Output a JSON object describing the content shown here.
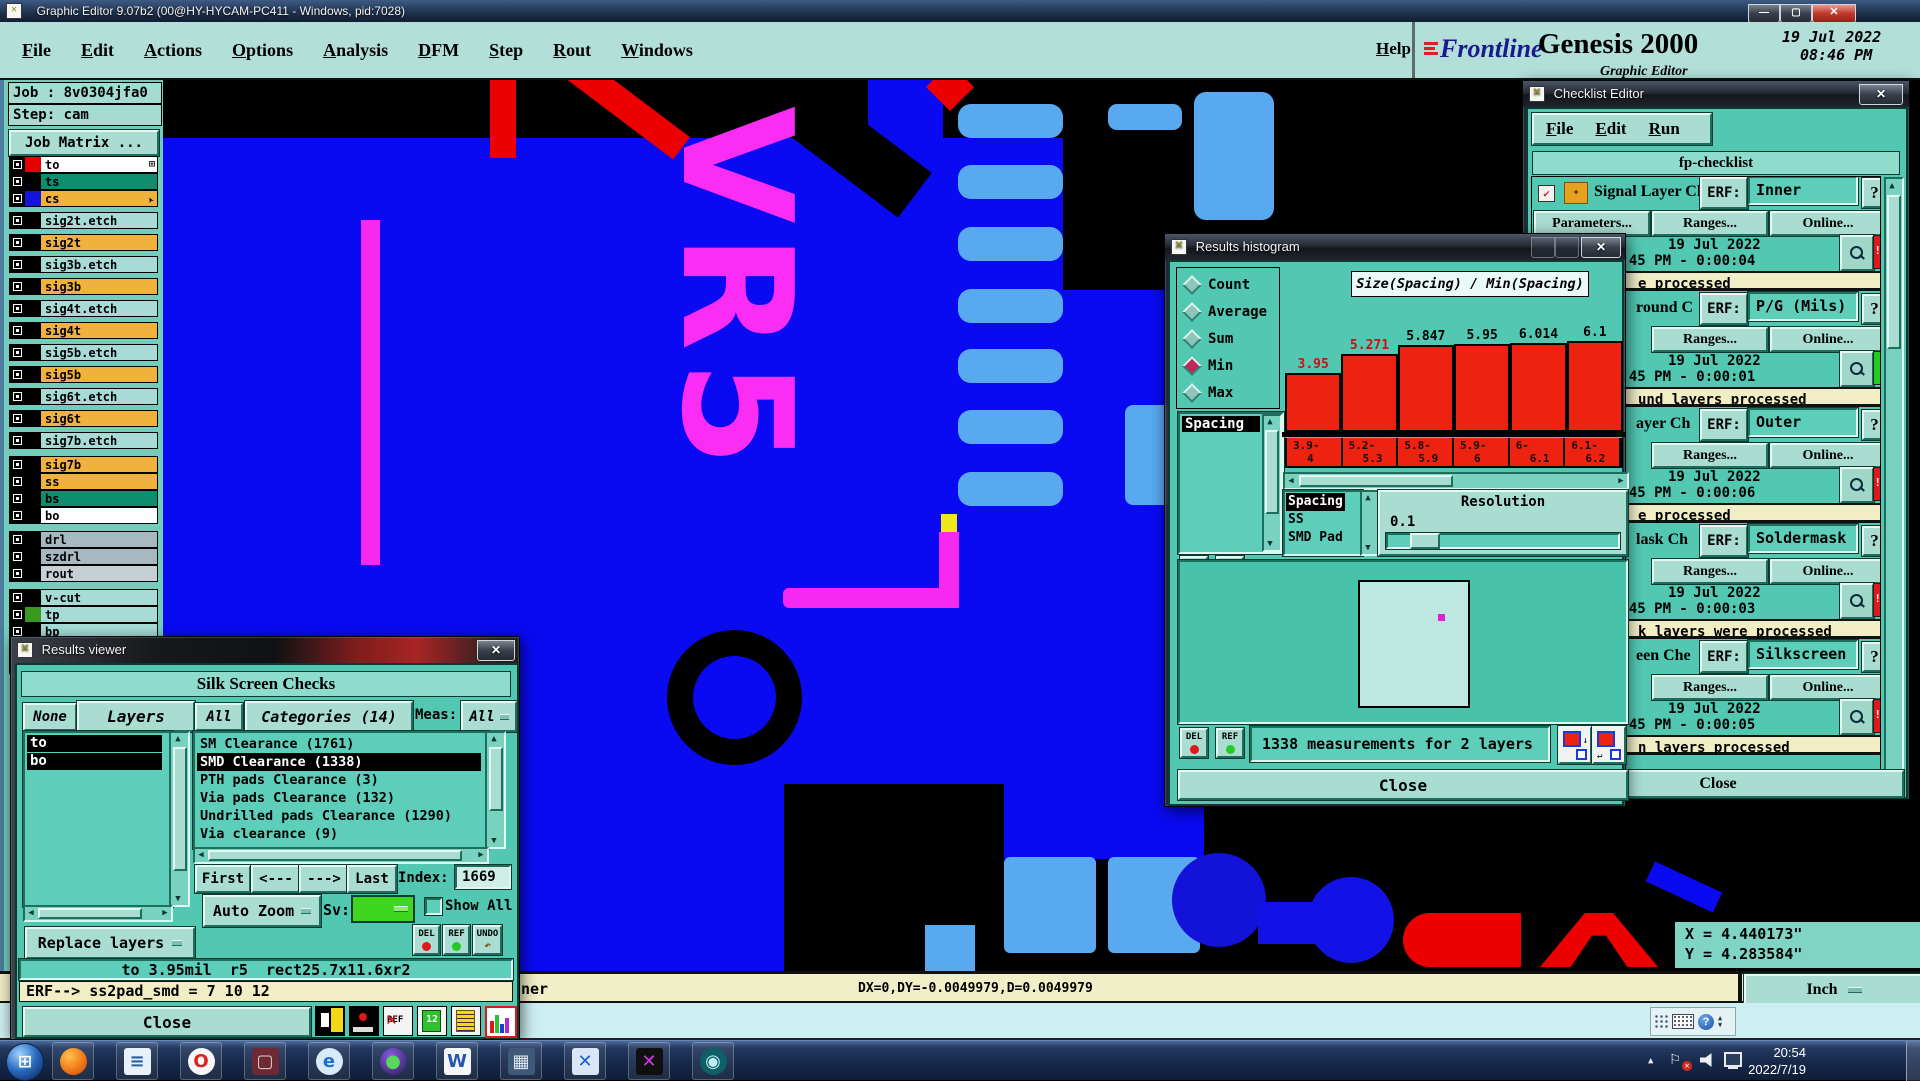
{
  "glyphs": {
    "min": "—",
    "max": "▢",
    "close": "✕",
    "up": "▲",
    "down": "▼",
    "left": "◀",
    "right": "▶",
    "q": "?",
    "bang": "!!",
    "check": "✔",
    "grid": "⊞",
    "start": "⊞",
    "tray_up": "▲",
    "flag": "⚐"
  },
  "window": {
    "title": "Graphic Editor 9.07b2 (00@HY-HYCAM-PC411 - Windows, pid:7028)"
  },
  "menubar": {
    "items": [
      "File",
      "Edit",
      "Actions",
      "Options",
      "Analysis",
      "DFM",
      "Step",
      "Rout",
      "Windows"
    ],
    "help": "Help",
    "brand": {
      "name": "Frontline",
      "product": "Genesis 2000",
      "subtitle": "Graphic Editor",
      "date": "19 Jul 2022",
      "time": "08:46 PM"
    }
  },
  "sidebar": {
    "job": "Job : 8v0304jfa0",
    "step": "Step: cam",
    "job_matrix": "Job Matrix ...",
    "layers": [
      {
        "name": "to",
        "bg": "#ffffff",
        "sw": "#e60000",
        "mt": "0px",
        "trail": "⊞",
        "rot": "none"
      },
      {
        "name": "ts",
        "bg": "#0e8e6e",
        "sw": "#000000",
        "mt": "0px",
        "trail": "",
        "rot": "none"
      },
      {
        "name": "cs",
        "bg": "#f0b23c",
        "sw": "#1414dd",
        "mt": "0px",
        "trail": "➤",
        "rot": "rotate(-120deg)"
      },
      {
        "name": "sig2t.etch",
        "bg": "#a6dbd6",
        "sw": "#000000",
        "mt": "5px",
        "trail": "",
        "rot": "none"
      },
      {
        "name": "sig2t",
        "bg": "#f0b23c",
        "sw": "#000000",
        "mt": "5px",
        "trail": "",
        "rot": "none"
      },
      {
        "name": "sig3b.etch",
        "bg": "#a6dbd6",
        "sw": "#000000",
        "mt": "5px",
        "trail": "",
        "rot": "none"
      },
      {
        "name": "sig3b",
        "bg": "#f0b23c",
        "sw": "#000000",
        "mt": "5px",
        "trail": "",
        "rot": "none"
      },
      {
        "name": "sig4t.etch",
        "bg": "#a6dbd6",
        "sw": "#000000",
        "mt": "5px",
        "trail": "",
        "rot": "none"
      },
      {
        "name": "sig4t",
        "bg": "#f0b23c",
        "sw": "#000000",
        "mt": "5px",
        "trail": "",
        "rot": "none"
      },
      {
        "name": "sig5b.etch",
        "bg": "#a6dbd6",
        "sw": "#000000",
        "mt": "5px",
        "trail": "",
        "rot": "none"
      },
      {
        "name": "sig5b",
        "bg": "#f0b23c",
        "sw": "#000000",
        "mt": "5px",
        "trail": "",
        "rot": "none"
      },
      {
        "name": "sig6t.etch",
        "bg": "#a6dbd6",
        "sw": "#000000",
        "mt": "5px",
        "trail": "",
        "rot": "none"
      },
      {
        "name": "sig6t",
        "bg": "#f0b23c",
        "sw": "#000000",
        "mt": "5px",
        "trail": "",
        "rot": "none"
      },
      {
        "name": "sig7b.etch",
        "bg": "#a6dbd6",
        "sw": "#000000",
        "mt": "5px",
        "trail": "",
        "rot": "none"
      },
      {
        "name": "sig7b",
        "bg": "#f0b23c",
        "sw": "#000000",
        "mt": "7px",
        "trail": "",
        "rot": "none"
      },
      {
        "name": "ss",
        "bg": "#f0b23c",
        "sw": "#000000",
        "mt": "0px",
        "trail": "",
        "rot": "none"
      },
      {
        "name": "bs",
        "bg": "#0e8e6e",
        "sw": "#000000",
        "mt": "0px",
        "trail": "",
        "rot": "none"
      },
      {
        "name": "bo",
        "bg": "#ffffff",
        "sw": "#000000",
        "mt": "0px",
        "trail": "",
        "rot": "none"
      },
      {
        "name": "drl",
        "bg": "#a8b8c0",
        "sw": "#000000",
        "mt": "7px",
        "trail": "",
        "rot": "none"
      },
      {
        "name": "szdrl",
        "bg": "#a8b8c0",
        "sw": "#000000",
        "mt": "0px",
        "trail": "",
        "rot": "none"
      },
      {
        "name": "rout",
        "bg": "#c6d0d4",
        "sw": "#000000",
        "mt": "0px",
        "trail": "",
        "rot": "none"
      },
      {
        "name": "v-cut",
        "bg": "#a6dbd6",
        "sw": "#000000",
        "mt": "7px",
        "trail": "",
        "rot": "none"
      },
      {
        "name": "tp",
        "bg": "#a6dbd6",
        "sw": "#3a9a20",
        "mt": "0px",
        "trail": "",
        "rot": "none"
      },
      {
        "name": "bp",
        "bg": "#a6dbd6",
        "sw": "#000000",
        "mt": "0px",
        "trail": "",
        "rot": "none"
      },
      {
        "name": "np",
        "bg": "#a6dbd6",
        "sw": "#000000",
        "mt": "0px",
        "trail": "",
        "rot": "none"
      },
      {
        "name": "mpth",
        "bg": "#a6dbd6",
        "sw": "#000000",
        "mt": "0px",
        "trail": "",
        "rot": "none"
      }
    ]
  },
  "canvas": {
    "vr5": "VR5",
    "coord_x": "X = 4.440173\"",
    "coord_y": "Y = 4.283584\""
  },
  "results_viewer": {
    "title": "Results viewer",
    "header": "Silk Screen Checks",
    "none": "None",
    "layers_btn": "Layers",
    "all": "All",
    "categories": "Categories (14)",
    "meas": "Meas:",
    "meas_value": "All",
    "layer_list": [
      {
        "label": "to"
      },
      {
        "label": "bo"
      }
    ],
    "cat_list": [
      {
        "label": "SM Clearance (1761)",
        "bg": "transparent",
        "fg": "#000000"
      },
      {
        "label": "SMD Clearance (1338)",
        "bg": "#000000",
        "fg": "#ffffff"
      },
      {
        "label": "PTH pads Clearance (3)",
        "bg": "transparent",
        "fg": "#000000"
      },
      {
        "label": "Via pads Clearance (132)",
        "bg": "transparent",
        "fg": "#000000"
      },
      {
        "label": "Undrilled pads Clearance (1290)",
        "bg": "transparent",
        "fg": "#000000"
      },
      {
        "label": "Via clearance (9)",
        "bg": "transparent",
        "fg": "#000000"
      }
    ],
    "nav": {
      "first": "First",
      "prev": "<---",
      "next": "--->",
      "last": "Last",
      "index_label": "Index:",
      "index_value": "1669"
    },
    "auto_zoom": "Auto Zoom",
    "sv": "Sv:",
    "show_all": "Show All",
    "replace": "Replace layers",
    "del": "DEL",
    "ref": "REF",
    "undo": "UNDO",
    "status1": "to 3.95mil  r5  rect25.7x11.6xr2",
    "status2": "ERF--> ss2pad_smd = 7 10 12",
    "close": "Close",
    "icon12": "12",
    "icon_ref": "REF"
  },
  "histogram": {
    "title": "Results histogram",
    "stats": [
      {
        "label": "Count",
        "dcol": "#8fc4ba"
      },
      {
        "label": "Average",
        "dcol": "#8fc4ba"
      },
      {
        "label": "Sum",
        "dcol": "#8fc4ba"
      },
      {
        "label": "Min",
        "dcol": "#c2245c"
      },
      {
        "label": "Max",
        "dcol": "#8fc4ba"
      }
    ],
    "series_list": [
      {
        "label": "Spacing",
        "bg": "#000000",
        "fg": "#ffffff"
      }
    ],
    "sub_list": [
      {
        "label": "Spacing",
        "bg": "#000000",
        "fg": "#ffffff"
      },
      {
        "label": "SS",
        "bg": "transparent",
        "fg": "#000000"
      },
      {
        "label": "SMD Pad",
        "bg": "transparent",
        "fg": "#000000"
      }
    ],
    "resolution_label": "Resolution",
    "resolution_value": "0.1",
    "del": "DEL",
    "ref": "REF",
    "measurements": "1338 measurements for 2 layers",
    "close": "Close",
    "chart_data": {
      "type": "bar",
      "title": "Size(Spacing) / Min(Spacing)",
      "categories": [
        "3.9-4",
        "5.2-5.3",
        "5.8-5.9",
        "5.9-6",
        "6-6.1",
        "6.1-6.2"
      ],
      "values": [
        3.95,
        5.271,
        5.847,
        5.95,
        6.014,
        6.1
      ],
      "value_label_colors": [
        "#cc1111",
        "#cc1111",
        "#000000",
        "#000000",
        "#000000",
        "#000000"
      ],
      "xlabel": "Size(Spacing) bins (mil)",
      "ylabel": "Min(Spacing)",
      "ylim": [
        0,
        6.2
      ],
      "bar_color": "#ee2211",
      "legend": "off",
      "grid": "off"
    }
  },
  "checklist": {
    "title": "Checklist Editor",
    "menu": [
      "File",
      "Edit",
      "Run"
    ],
    "header": "fp-checklist",
    "erf_label": "ERF:",
    "params": "Parameters...",
    "ranges": "Ranges...",
    "online": "Online...",
    "q": "?",
    "date1": "19 Jul 2022",
    "sections": [
      {
        "label": "Signal Layer Ch",
        "label_left": "62px",
        "value": "Inner",
        "time": "8:45 PM - 0:00:04",
        "status": "e processed",
        "status_pad": "106px",
        "ind_bg": "#e01818",
        "ind_txt": "!!",
        "params_disp": "flex",
        "cb_disp": "flex"
      },
      {
        "label": "round C",
        "label_left": "104px",
        "value": "P/G (Mils)",
        "time": "8:45 PM - 0:00:01",
        "status": "und layers processed",
        "status_pad": "106px",
        "ind_bg": "#22cc22",
        "ind_txt": "",
        "params_disp": "none",
        "cb_disp": "flex"
      },
      {
        "label": "ayer Ch",
        "label_left": "104px",
        "value": "Outer",
        "time": "8:45 PM - 0:00:06",
        "status": "e processed",
        "status_pad": "106px",
        "ind_bg": "#e01818",
        "ind_txt": "!!",
        "params_disp": "none",
        "cb_disp": "flex"
      },
      {
        "label": "lask Ch",
        "label_left": "104px",
        "value": "Soldermask",
        "time": "8:45 PM - 0:00:03",
        "status": "k layers were processed",
        "status_pad": "106px",
        "ind_bg": "#e01818",
        "ind_txt": "!!",
        "params_disp": "none",
        "cb_disp": "flex"
      },
      {
        "label": "een Che",
        "label_left": "104px",
        "value": "Silkscreen",
        "time": "8:45 PM - 0:00:05",
        "status": "n layers processed",
        "status_pad": "106px",
        "ind_bg": "#e01818",
        "ind_txt": "!!",
        "params_disp": "none",
        "cb_disp": "flex"
      }
    ],
    "close": "Close"
  },
  "statusbar": {
    "left_fragment": "ner",
    "delta": "DX=0,DY=-0.0049979,D=0.0049979",
    "unit": "Inch"
  },
  "taskbar": {
    "time": "20:54",
    "date": "2022/7/19",
    "icons": [
      {
        "name": "firefox-icon",
        "glyph": "",
        "fg": "#fff",
        "bg": "radial-gradient(circle at 35% 30%,#ffc24a,#f07818 55%,#c24a08)",
        "br": "50%"
      },
      {
        "name": "notepad-icon",
        "glyph": "≡",
        "fg": "#2a5f9e",
        "bg": "#e8f0f8",
        "br": "3px"
      },
      {
        "name": "opera-icon",
        "glyph": "O",
        "fg": "#e02020",
        "bg": "#f8f8f8",
        "br": "50%"
      },
      {
        "name": "floppy-icon",
        "glyph": "▢",
        "fg": "#d8d0d0",
        "bg": "#6e2a34",
        "br": "3px"
      },
      {
        "name": "ie-icon",
        "glyph": "e",
        "fg": "#1f6fd0",
        "bg": "#d8eaf8",
        "br": "50%"
      },
      {
        "name": "media-orb-icon",
        "glyph": "●",
        "fg": "#58d858",
        "bg": "radial-gradient(circle at 40% 30%,#8a5ae8,#2a1a50)",
        "br": "50%"
      },
      {
        "name": "writer-icon",
        "glyph": "W",
        "fg": "#2458b0",
        "bg": "#f4f6f8",
        "br": "3px"
      },
      {
        "name": "calculator-icon",
        "glyph": "▦",
        "fg": "#dfe8f0",
        "bg": "#3f5a78",
        "br": "3px"
      },
      {
        "name": "transfer-icon",
        "glyph": "✕",
        "fg": "#1f5fd0",
        "bg": "#d8e6f6",
        "br": "3px"
      },
      {
        "name": "xming-icon",
        "glyph": "✕",
        "fg": "#cf3ae8",
        "bg": "#101010",
        "br": "3px"
      },
      {
        "name": "viewer-eye-icon",
        "glyph": "◉",
        "fg": "#bfeff2",
        "bg": "#0f5f66",
        "br": "50%"
      }
    ]
  }
}
